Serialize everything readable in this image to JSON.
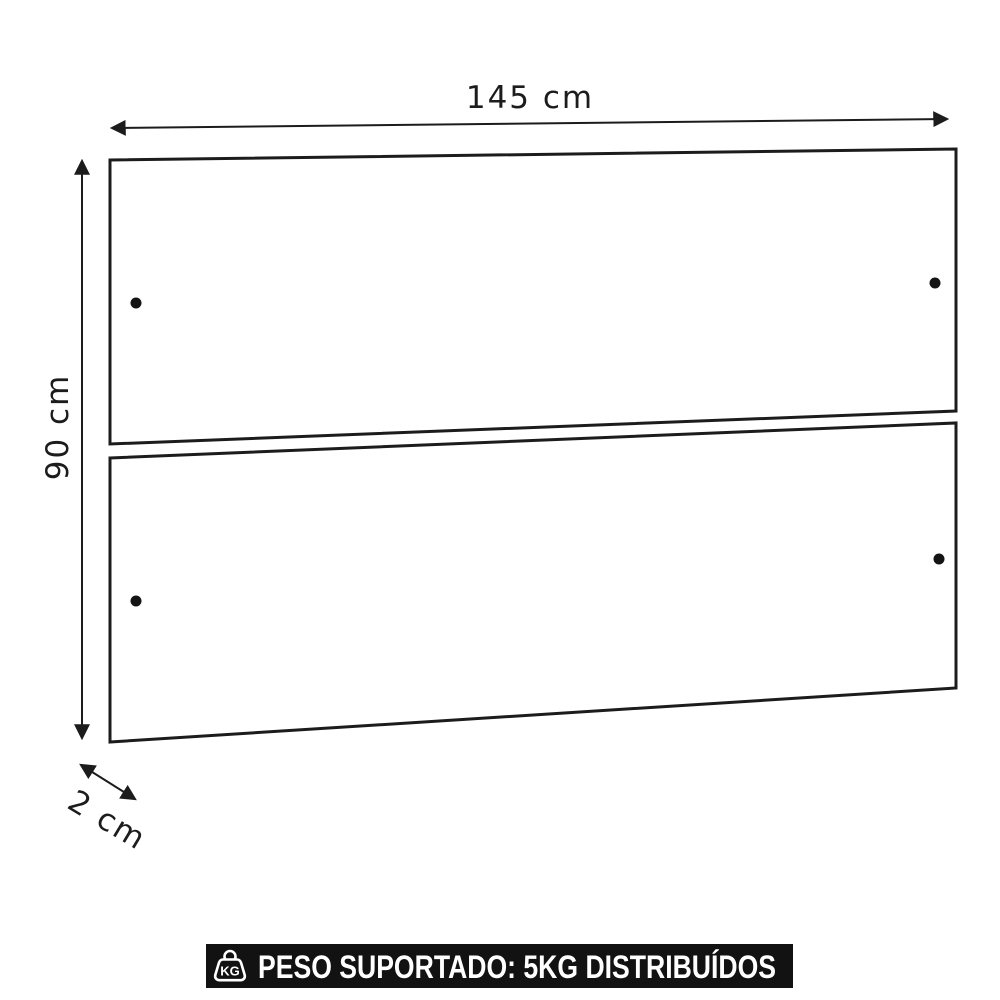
{
  "diagram": {
    "name": "two-panel-headboard-dimension-diagram",
    "width_label": "145 cm",
    "height_label": "90 cm",
    "depth_label": "2 cm"
  },
  "banner": {
    "kg_icon_label": "KG",
    "text": "PESO SUPORTADO: 5KG DISTRIBUÍDOS"
  },
  "colors": {
    "line": "#1c1c1c",
    "background": "#ffffff",
    "banner_bg": "#121212",
    "banner_text": "#ffffff"
  }
}
